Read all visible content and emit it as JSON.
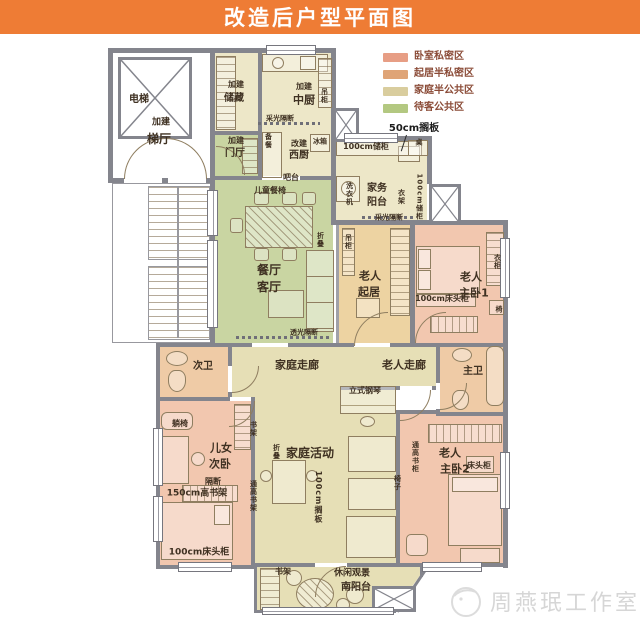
{
  "title": "改造后户型平面图",
  "colors": {
    "title_bar": "#EE7C35",
    "wall": "#84858D",
    "zone_bedroom": "#E79E85",
    "zone_living": "#DFA477",
    "zone_family": "#D9CD9E",
    "zone_guest": "#B3C881"
  },
  "legend": {
    "items": [
      {
        "label": "卧室私密区",
        "color": "#E79E85"
      },
      {
        "label": "起居半私密区",
        "color": "#DFA477"
      },
      {
        "label": "家庭半公共区",
        "color": "#D9CD9E"
      },
      {
        "label": "待客公共区",
        "color": "#B3C881"
      }
    ]
  },
  "labels": [
    {
      "t": "电梯",
      "x": 139,
      "y": 100,
      "fs": 10
    },
    {
      "t": "加建",
      "x": 161,
      "y": 123,
      "fs": 9
    },
    {
      "t": "梯厅",
      "x": 159,
      "y": 139,
      "fs": 12
    },
    {
      "t": "加建",
      "x": 236,
      "y": 85,
      "fs": 8
    },
    {
      "t": "储藏",
      "x": 234,
      "y": 99,
      "fs": 10
    },
    {
      "t": "加建",
      "x": 236,
      "y": 141,
      "fs": 8
    },
    {
      "t": "门厅",
      "x": 235,
      "y": 154,
      "fs": 10
    },
    {
      "t": "加建",
      "x": 304,
      "y": 87,
      "fs": 8
    },
    {
      "t": "中厨",
      "x": 304,
      "y": 100,
      "fs": 11
    },
    {
      "t": "吊柜",
      "x": 324,
      "y": 96,
      "fs": 7,
      "v": 1
    },
    {
      "t": "采光隔断",
      "x": 280,
      "y": 119,
      "fs": 7
    },
    {
      "t": "备餐",
      "x": 268,
      "y": 141,
      "fs": 7,
      "v": 1
    },
    {
      "t": "改建",
      "x": 299,
      "y": 144,
      "fs": 8
    },
    {
      "t": "西厨",
      "x": 299,
      "y": 156,
      "fs": 10
    },
    {
      "t": "冰箱",
      "x": 320,
      "y": 142,
      "fs": 7
    },
    {
      "t": "吧台",
      "x": 291,
      "y": 178,
      "fs": 8
    },
    {
      "t": "50cm搁板",
      "x": 414,
      "y": 129,
      "fs": 10,
      "c": "#1d1d1d"
    },
    {
      "t": "100cm储柜",
      "x": 366,
      "y": 147,
      "fs": 8
    },
    {
      "t": "桌",
      "x": 419,
      "y": 143,
      "fs": 7
    },
    {
      "t": "洗衣机",
      "x": 349,
      "y": 194,
      "fs": 7,
      "v": 1
    },
    {
      "t": "家务",
      "x": 377,
      "y": 189,
      "fs": 10
    },
    {
      "t": "阳台",
      "x": 377,
      "y": 203,
      "fs": 10
    },
    {
      "t": "衣架",
      "x": 401,
      "y": 197,
      "fs": 7,
      "v": 1
    },
    {
      "t": "采光隔断",
      "x": 389,
      "y": 218,
      "fs": 7
    },
    {
      "t": "100cm储柜",
      "x": 419,
      "y": 197,
      "fs": 7,
      "v": 1
    },
    {
      "t": "吊柜",
      "x": 348,
      "y": 242,
      "fs": 7,
      "v": 1
    },
    {
      "t": "老人",
      "x": 370,
      "y": 276,
      "fs": 11
    },
    {
      "t": "起居",
      "x": 369,
      "y": 292,
      "fs": 11
    },
    {
      "t": "折叠",
      "x": 320,
      "y": 240,
      "fs": 7,
      "v": 1
    },
    {
      "t": "儿童餐椅",
      "x": 270,
      "y": 191,
      "fs": 8
    },
    {
      "t": "餐厅",
      "x": 269,
      "y": 270,
      "fs": 12
    },
    {
      "t": "客厅",
      "x": 269,
      "y": 287,
      "fs": 12
    },
    {
      "t": "透光隔断",
      "x": 304,
      "y": 333,
      "fs": 7
    },
    {
      "t": "老人",
      "x": 471,
      "y": 277,
      "fs": 11
    },
    {
      "t": "主卧1",
      "x": 474,
      "y": 293,
      "fs": 11
    },
    {
      "t": "100cm床头柜",
      "x": 442,
      "y": 299,
      "fs": 8
    },
    {
      "t": "椅",
      "x": 499,
      "y": 310,
      "fs": 7
    },
    {
      "t": "衣柜",
      "x": 497,
      "y": 262,
      "fs": 7,
      "v": 1
    },
    {
      "t": "次卫",
      "x": 203,
      "y": 367,
      "fs": 10
    },
    {
      "t": "家庭走廊",
      "x": 297,
      "y": 365,
      "fs": 11
    },
    {
      "t": "老人走廊",
      "x": 404,
      "y": 365,
      "fs": 11
    },
    {
      "t": "主卫",
      "x": 473,
      "y": 372,
      "fs": 10
    },
    {
      "t": "立式钢琴",
      "x": 365,
      "y": 391,
      "fs": 8
    },
    {
      "t": "躺椅",
      "x": 180,
      "y": 424,
      "fs": 8
    },
    {
      "t": "儿女",
      "x": 221,
      "y": 448,
      "fs": 11
    },
    {
      "t": "次卧",
      "x": 220,
      "y": 464,
      "fs": 11
    },
    {
      "t": "隔断",
      "x": 213,
      "y": 482,
      "fs": 8
    },
    {
      "t": "150cm高书架",
      "x": 197,
      "y": 494,
      "fs": 9
    },
    {
      "t": "100cm床头柜",
      "x": 199,
      "y": 553,
      "fs": 9
    },
    {
      "t": "书架",
      "x": 253,
      "y": 429,
      "fs": 7,
      "v": 1
    },
    {
      "t": "通高书架",
      "x": 253,
      "y": 496,
      "fs": 7,
      "v": 1
    },
    {
      "t": "家庭活动",
      "x": 310,
      "y": 453,
      "fs": 12
    },
    {
      "t": "折叠",
      "x": 276,
      "y": 452,
      "fs": 7,
      "v": 1
    },
    {
      "t": "100cm搁板",
      "x": 318,
      "y": 497,
      "fs": 8,
      "v": 1
    },
    {
      "t": "椅子",
      "x": 397,
      "y": 483,
      "fs": 7,
      "v": 1
    },
    {
      "t": "通高书柜",
      "x": 415,
      "y": 457,
      "fs": 7,
      "v": 1
    },
    {
      "t": "老人",
      "x": 450,
      "y": 453,
      "fs": 11
    },
    {
      "t": "主卧2",
      "x": 455,
      "y": 469,
      "fs": 11
    },
    {
      "t": "床头柜",
      "x": 479,
      "y": 466,
      "fs": 8
    },
    {
      "t": "书架",
      "x": 283,
      "y": 572,
      "fs": 8
    },
    {
      "t": "休闲观景",
      "x": 352,
      "y": 574,
      "fs": 9
    },
    {
      "t": "南阳台",
      "x": 356,
      "y": 588,
      "fs": 10
    }
  ],
  "watermark": {
    "text": "周燕珉工作室"
  }
}
